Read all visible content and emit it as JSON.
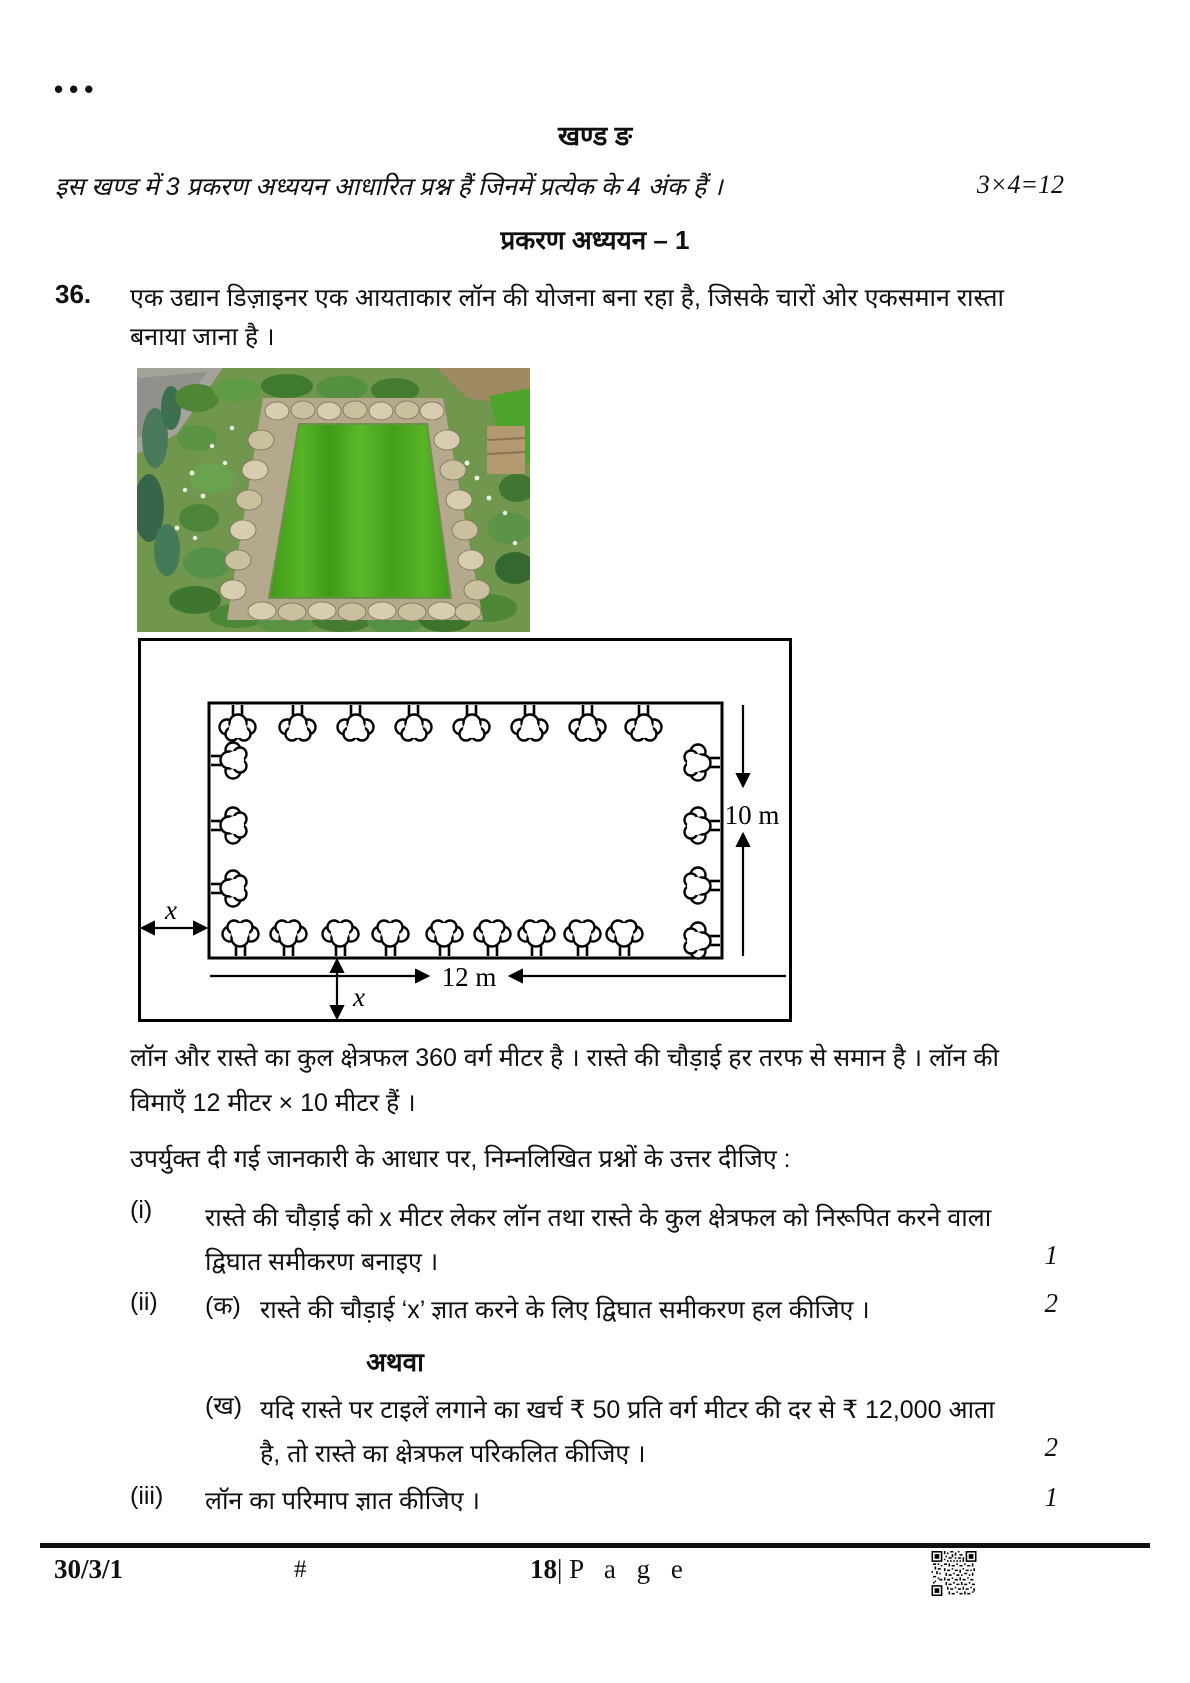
{
  "page": {
    "menu_dots": "•••",
    "footer": {
      "paper_code": "30/3/1",
      "hash": "#",
      "page_number": "18",
      "page_separator": "|",
      "page_word": "P a g e"
    }
  },
  "section": {
    "title": "खण्ड ङ",
    "instruction": "इस खण्ड में 3 प्रकरण अध्ययन आधारित प्रश्न हैं जिनमें प्रत्येक के 4 अंक हैं ।",
    "marks_scheme": "3×4=12",
    "case_study_title": "प्रकरण अध्ययन – 1"
  },
  "question": {
    "number": "36.",
    "intro": "एक उद्यान डिज़ाइनर एक आयताकार लॉन की योजना बना रहा है, जिसके चारों ओर एकसमान रास्ता बनाया जाना है ।",
    "diagram": {
      "lawn_width_label": "12 m",
      "lawn_height_label": "10 m",
      "path_width_label_left": "x",
      "path_width_label_bottom": "x"
    },
    "facts": "लॉन और रास्ते का कुल क्षेत्रफल 360 वर्ग मीटर है । रास्ते की चौड़ाई हर तरफ से समान है । लॉन की विमाएँ 12 मीटर × 10 मीटर हैं ।",
    "prompt": "उपर्युक्त दी गई जानकारी के आधार पर, निम्नलिखित प्रश्नों के उत्तर दीजिए :",
    "parts": {
      "i": {
        "label": "(i)",
        "text": "रास्ते की चौड़ाई को x मीटर लेकर लॉन तथा रास्ते के कुल क्षेत्रफल को निरूपित करने वाला द्विघात समीकरण बनाइए ।",
        "marks": "1"
      },
      "ii_a": {
        "label": "(ii)",
        "sub_label": "(क)",
        "text": "रास्ते की चौड़ाई ‘x’ ज्ञात करने के लिए द्विघात समीकरण हल कीजिए ।",
        "marks": "2"
      },
      "or_label": "अथवा",
      "ii_b": {
        "sub_label": "(ख)",
        "text": "यदि रास्ते पर टाइलें लगाने का खर्च ₹ 50 प्रति वर्ग मीटर की दर से ₹ 12,000 आता है, तो रास्ते का क्षेत्रफल परिकलित कीजिए ।",
        "marks": "2"
      },
      "iii": {
        "label": "(iii)",
        "text": "लॉन का परिमाप ज्ञात कीजिए ।",
        "marks": "1"
      }
    }
  }
}
